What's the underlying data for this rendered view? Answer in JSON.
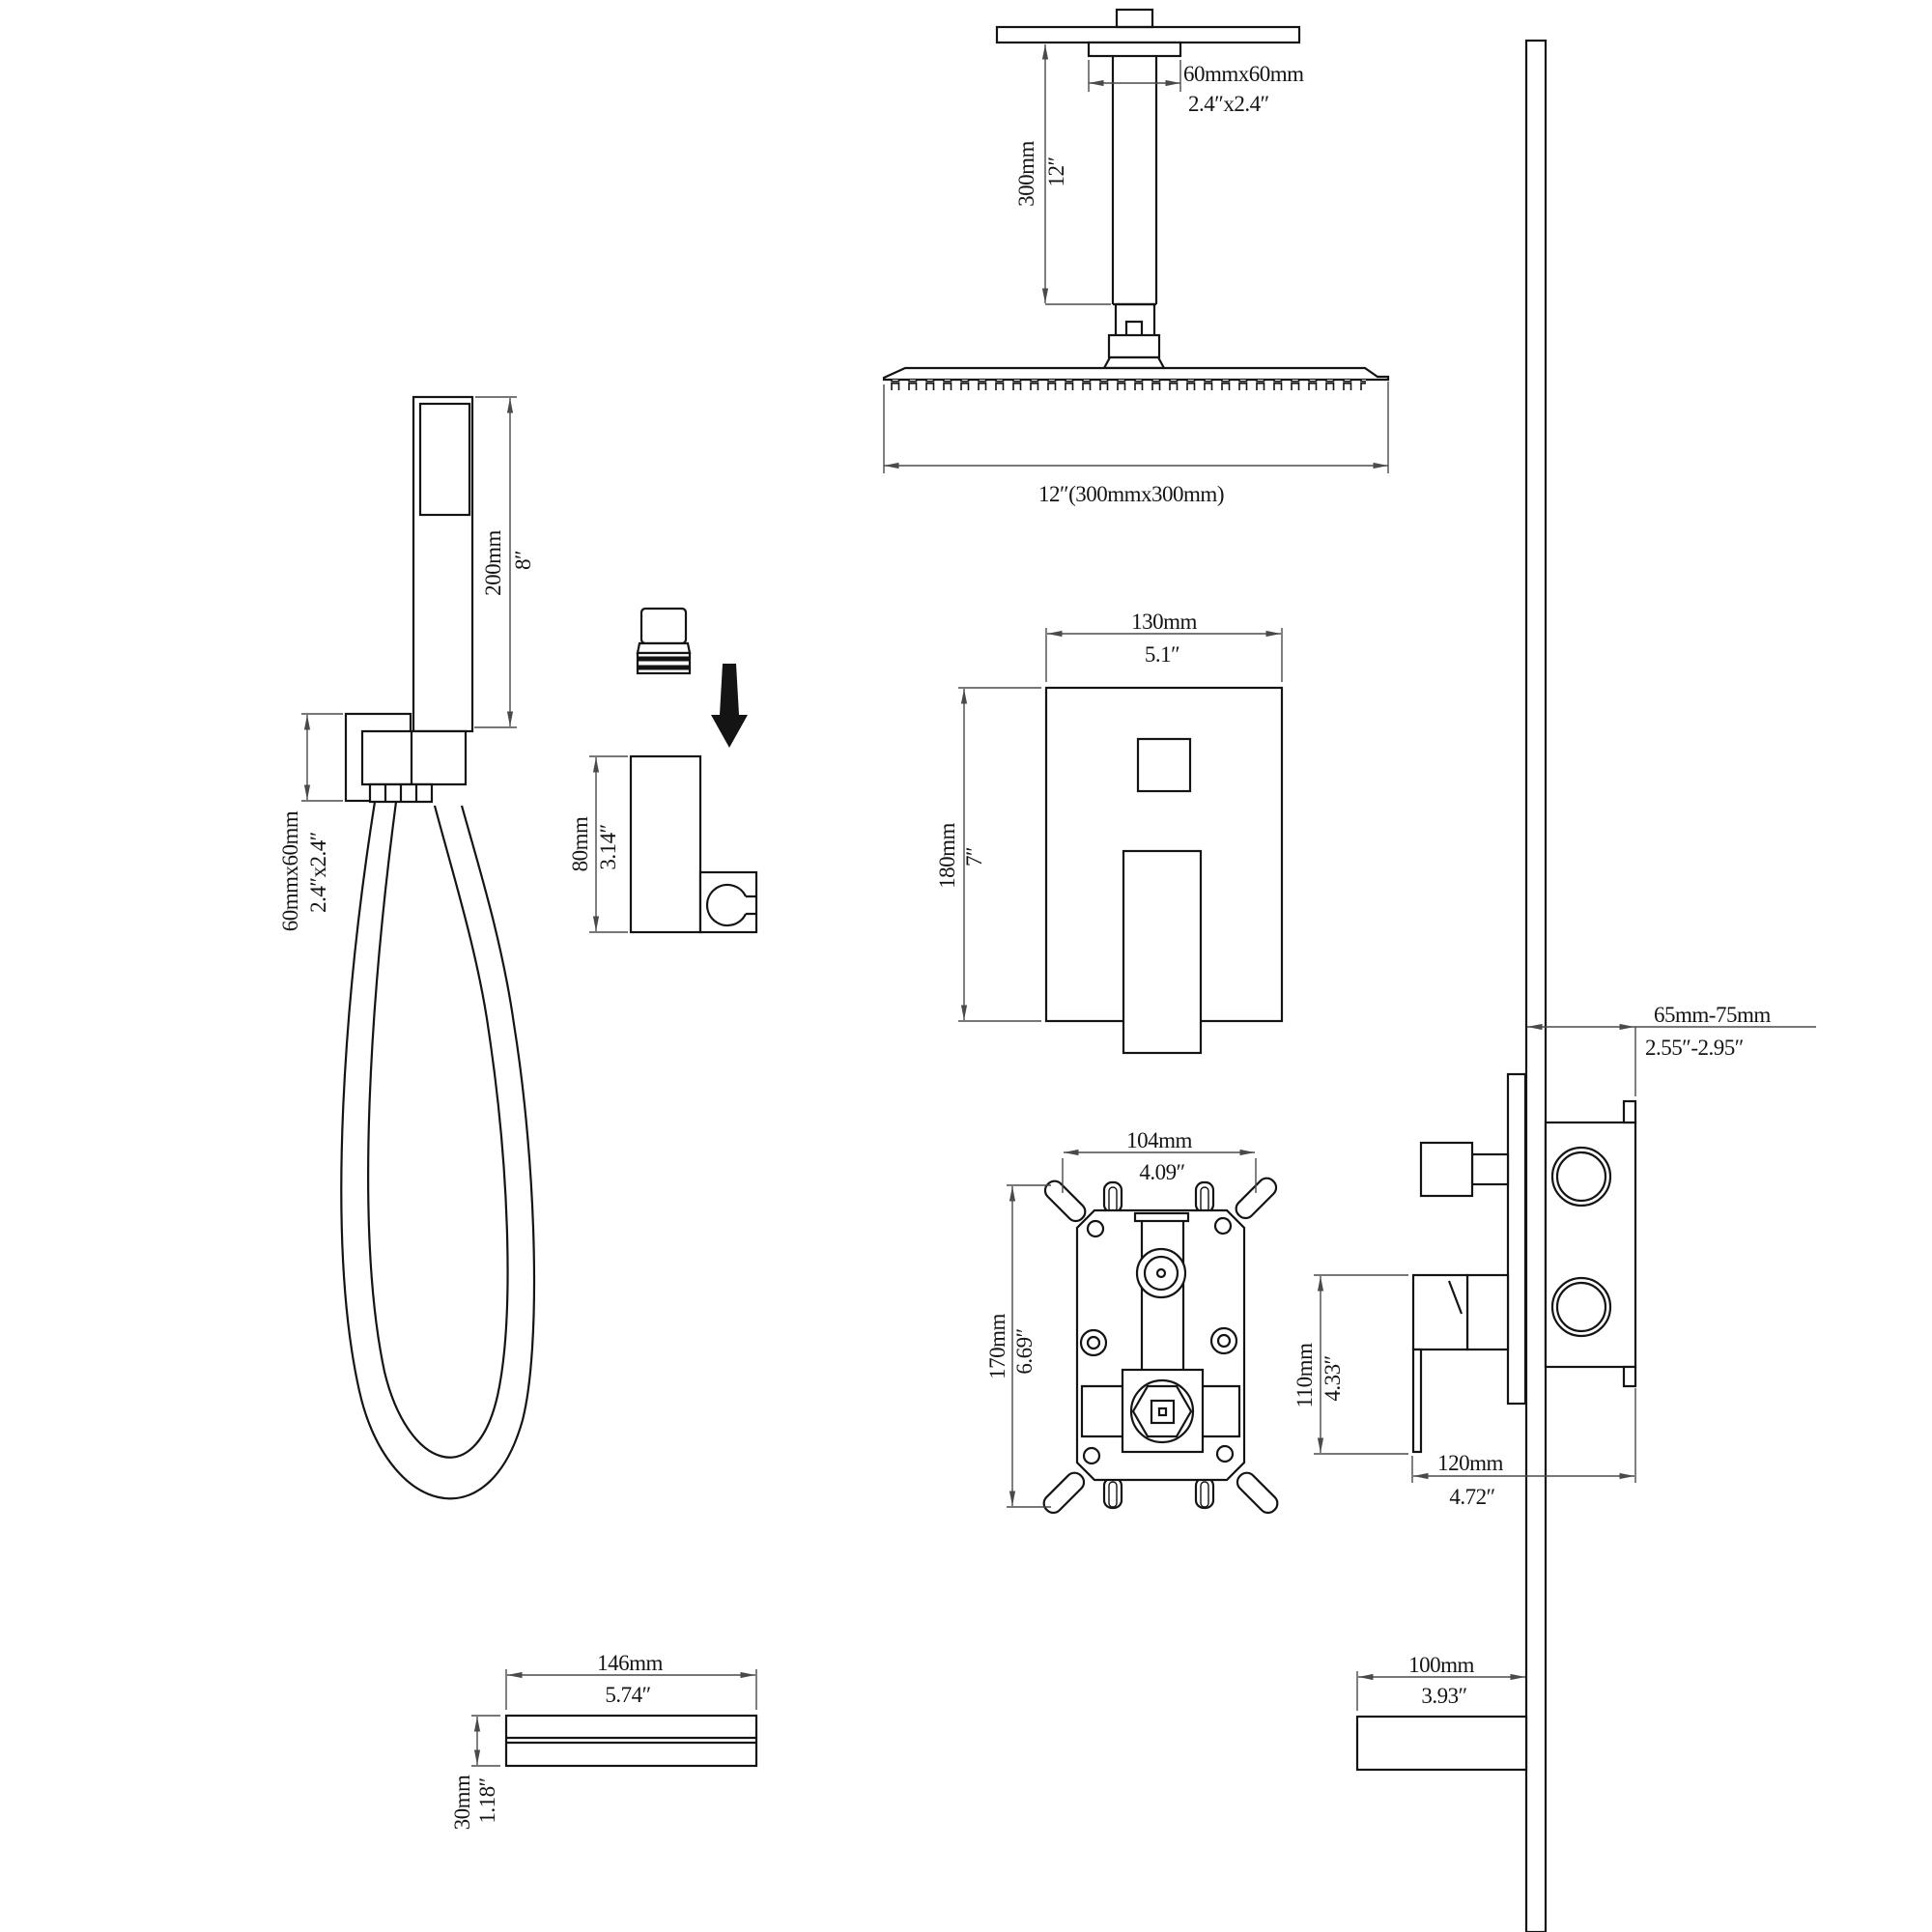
{
  "ceiling": {
    "mount_mm": "60mmx60mm",
    "mount_in": "2.4″x2.4″",
    "arm_mm": "300mm",
    "arm_in": "12″",
    "head_label": "12″(300mmx300mm)"
  },
  "handheld": {
    "len_mm": "200mm",
    "len_in": "8″",
    "bracket_mm": "60mmx60mm",
    "bracket_in": "2.4″x2.4″"
  },
  "holder": {
    "h_mm": "80mm",
    "h_in": "3.14″"
  },
  "trim_plate": {
    "w_mm": "130mm",
    "w_in": "5.1″",
    "h_mm": "180mm",
    "h_in": "7″"
  },
  "rough_valve": {
    "w_mm": "104mm",
    "w_in": "4.09″",
    "h_mm": "170mm",
    "h_in": "6.69″"
  },
  "side_view": {
    "depth_mm": "65mm-75mm",
    "depth_in": "2.55″-2.95″",
    "lever_mm": "110mm",
    "lever_in": "4.33″",
    "proj_mm": "120mm",
    "proj_in": "4.72″"
  },
  "spout_front": {
    "w_mm": "146mm",
    "w_in": "5.74″",
    "h_mm": "30mm",
    "h_in": "1.18″"
  },
  "spout_side": {
    "len_mm": "100mm",
    "len_in": "3.93″"
  }
}
